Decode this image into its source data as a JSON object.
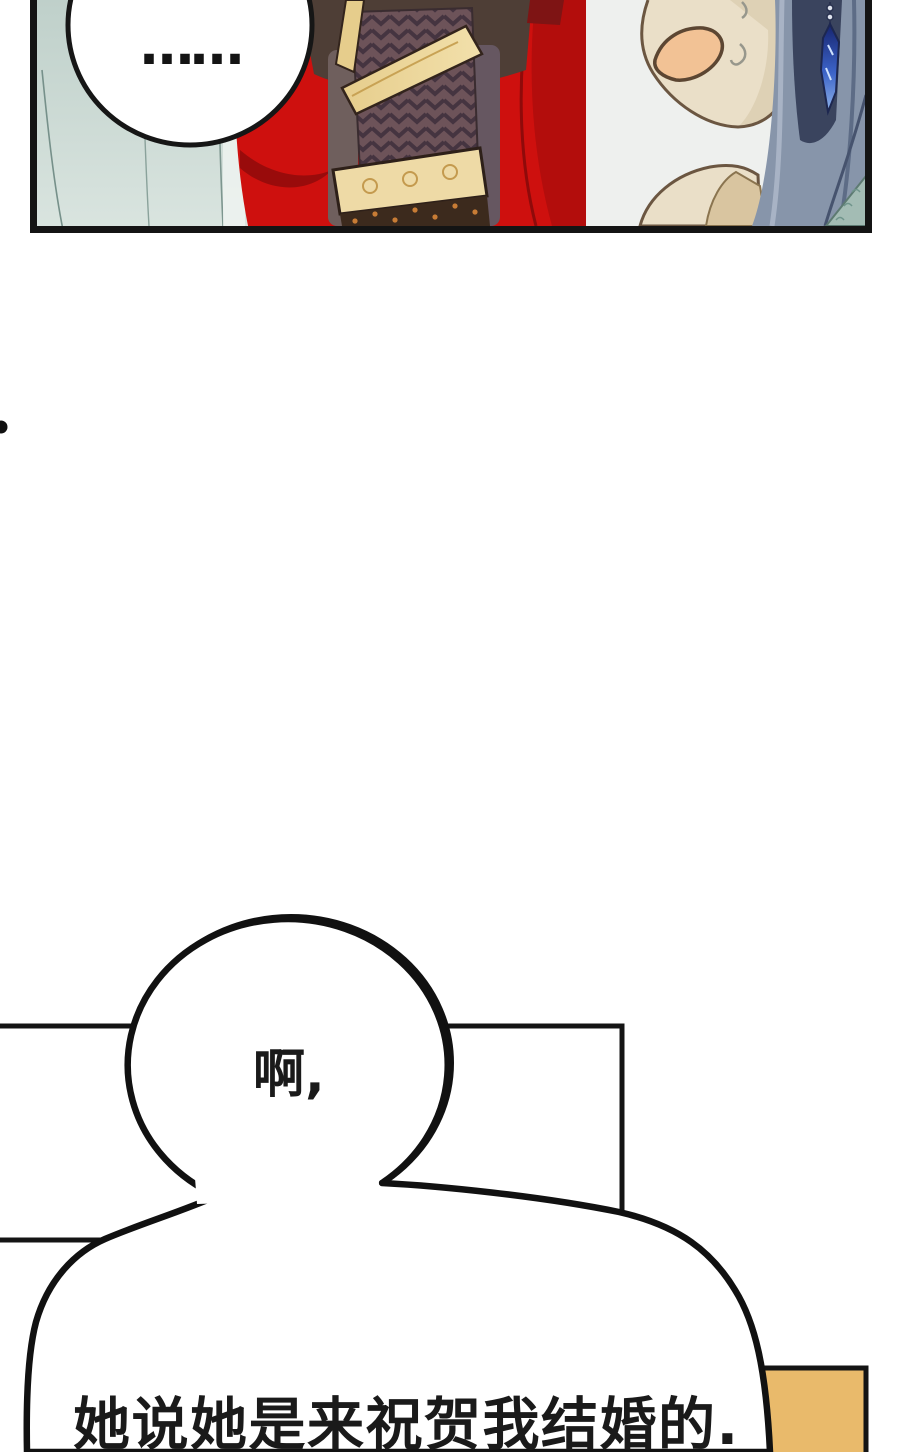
{
  "page": {
    "kind": "webtoon-comic-page",
    "background_color": "#ffffff",
    "width_px": 900,
    "height_px": 1452
  },
  "comic_panel": {
    "border_color": "#141414",
    "curtain_background_color": "#cbdad4",
    "speech_bubble": {
      "text": "……"
    },
    "cape_color": "#ce100e",
    "cape_shadow_color": "#8f0a0a",
    "sleeve_base_color": "#6d5359",
    "gold_trim_color": "#ecd394",
    "character_right": {
      "skin_color": "#eadfc8",
      "mouth_color": "#f2c295",
      "hair_color": "#8795aa",
      "hair_dark_color": "#3a445e",
      "earring_color": "#2a4ab8",
      "sweat_drops_count": 2
    }
  },
  "speech": {
    "bubble_ah": {
      "text": "啊,"
    },
    "bubble_main": {
      "text": "她说她是来祝贺我结婚的."
    }
  },
  "decor": {
    "gold_block_color": "#e9ba6b",
    "panel_frame_color": "#141414"
  }
}
